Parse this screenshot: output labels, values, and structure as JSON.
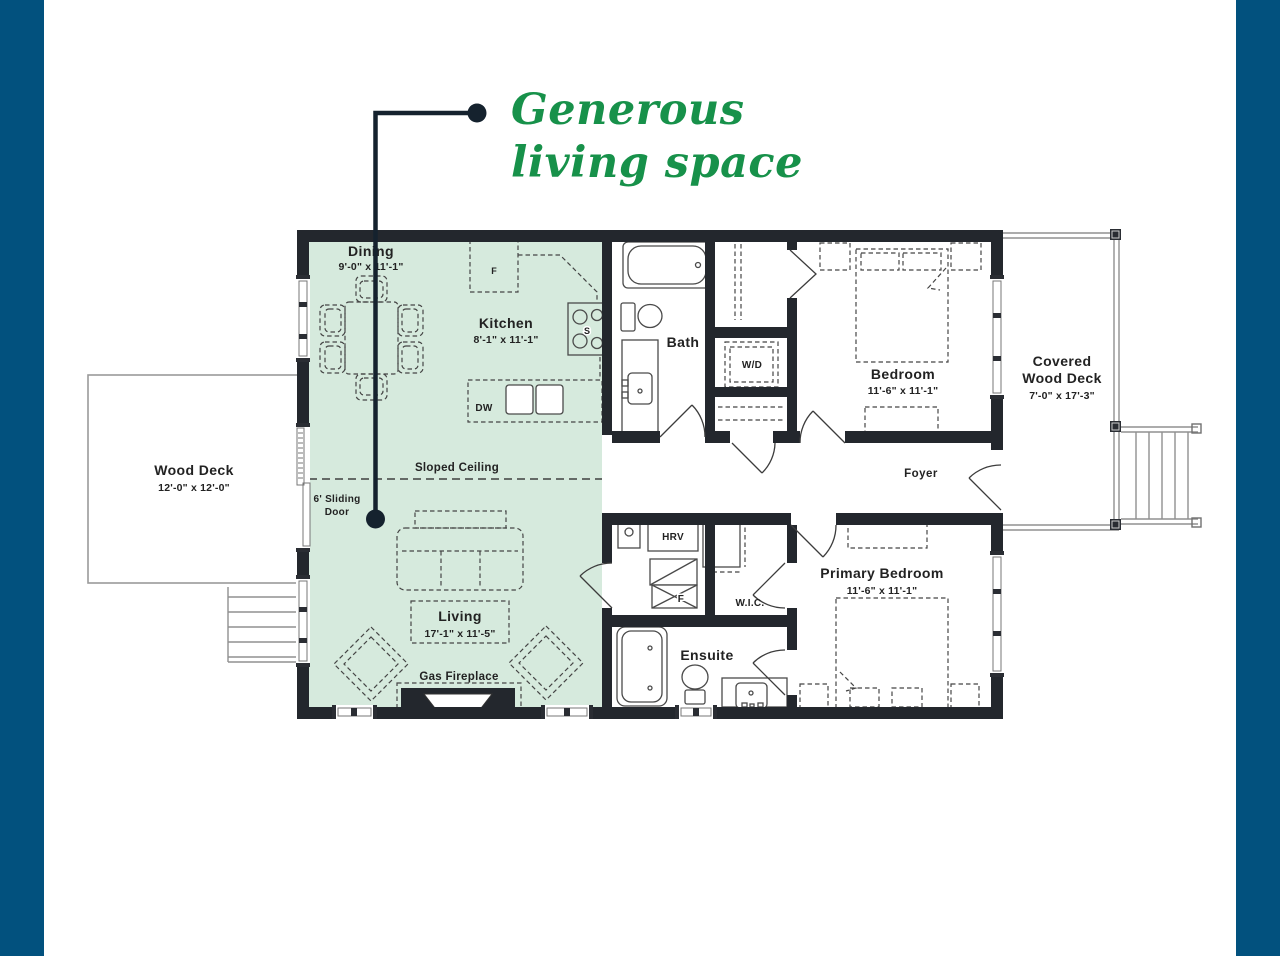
{
  "page": {
    "border_color": "#02517E",
    "background": "#FFFFFF"
  },
  "headline": {
    "line1": "Generous",
    "line2": "living space",
    "color": "#17914A"
  },
  "plan": {
    "colors": {
      "highlight": "#D6EADD",
      "wall": "#23272D",
      "callout": "#15222E"
    },
    "rooms": {
      "dining": {
        "name": "Dining",
        "dims": "9'-0\" x 11'-1\""
      },
      "kitchen": {
        "name": "Kitchen",
        "dims": "8'-1\" x 11'-1\""
      },
      "living": {
        "name": "Living",
        "dims": "17'-1\" x 11'-5\""
      },
      "bath": {
        "name": "Bath"
      },
      "bedroom": {
        "name": "Bedroom",
        "dims": "11'-6\" x 11'-1\""
      },
      "primary_bedroom": {
        "name": "Primary Bedroom",
        "dims": "11'-6\" x 11'-1\""
      },
      "ensuite": {
        "name": "Ensuite"
      },
      "foyer": {
        "name": "Foyer"
      },
      "wic": {
        "name": "W.I.C."
      },
      "covered_deck": {
        "name_line1": "Covered",
        "name_line2": "Wood Deck",
        "dims": "7'-0\" x 17'-3\""
      },
      "wood_deck": {
        "name": "Wood Deck",
        "dims": "12'-0\" x 12'-0\""
      }
    },
    "labels": {
      "sloped_ceiling": "Sloped Ceiling",
      "sliding_door_line1": "6' Sliding",
      "sliding_door_line2": "Door",
      "gas_fireplace": "Gas Fireplace",
      "washer_dryer": "W/D",
      "hrv": "HRV",
      "dishwasher": "DW",
      "fridge": "F",
      "stove": "S",
      "furnace": "F"
    }
  }
}
